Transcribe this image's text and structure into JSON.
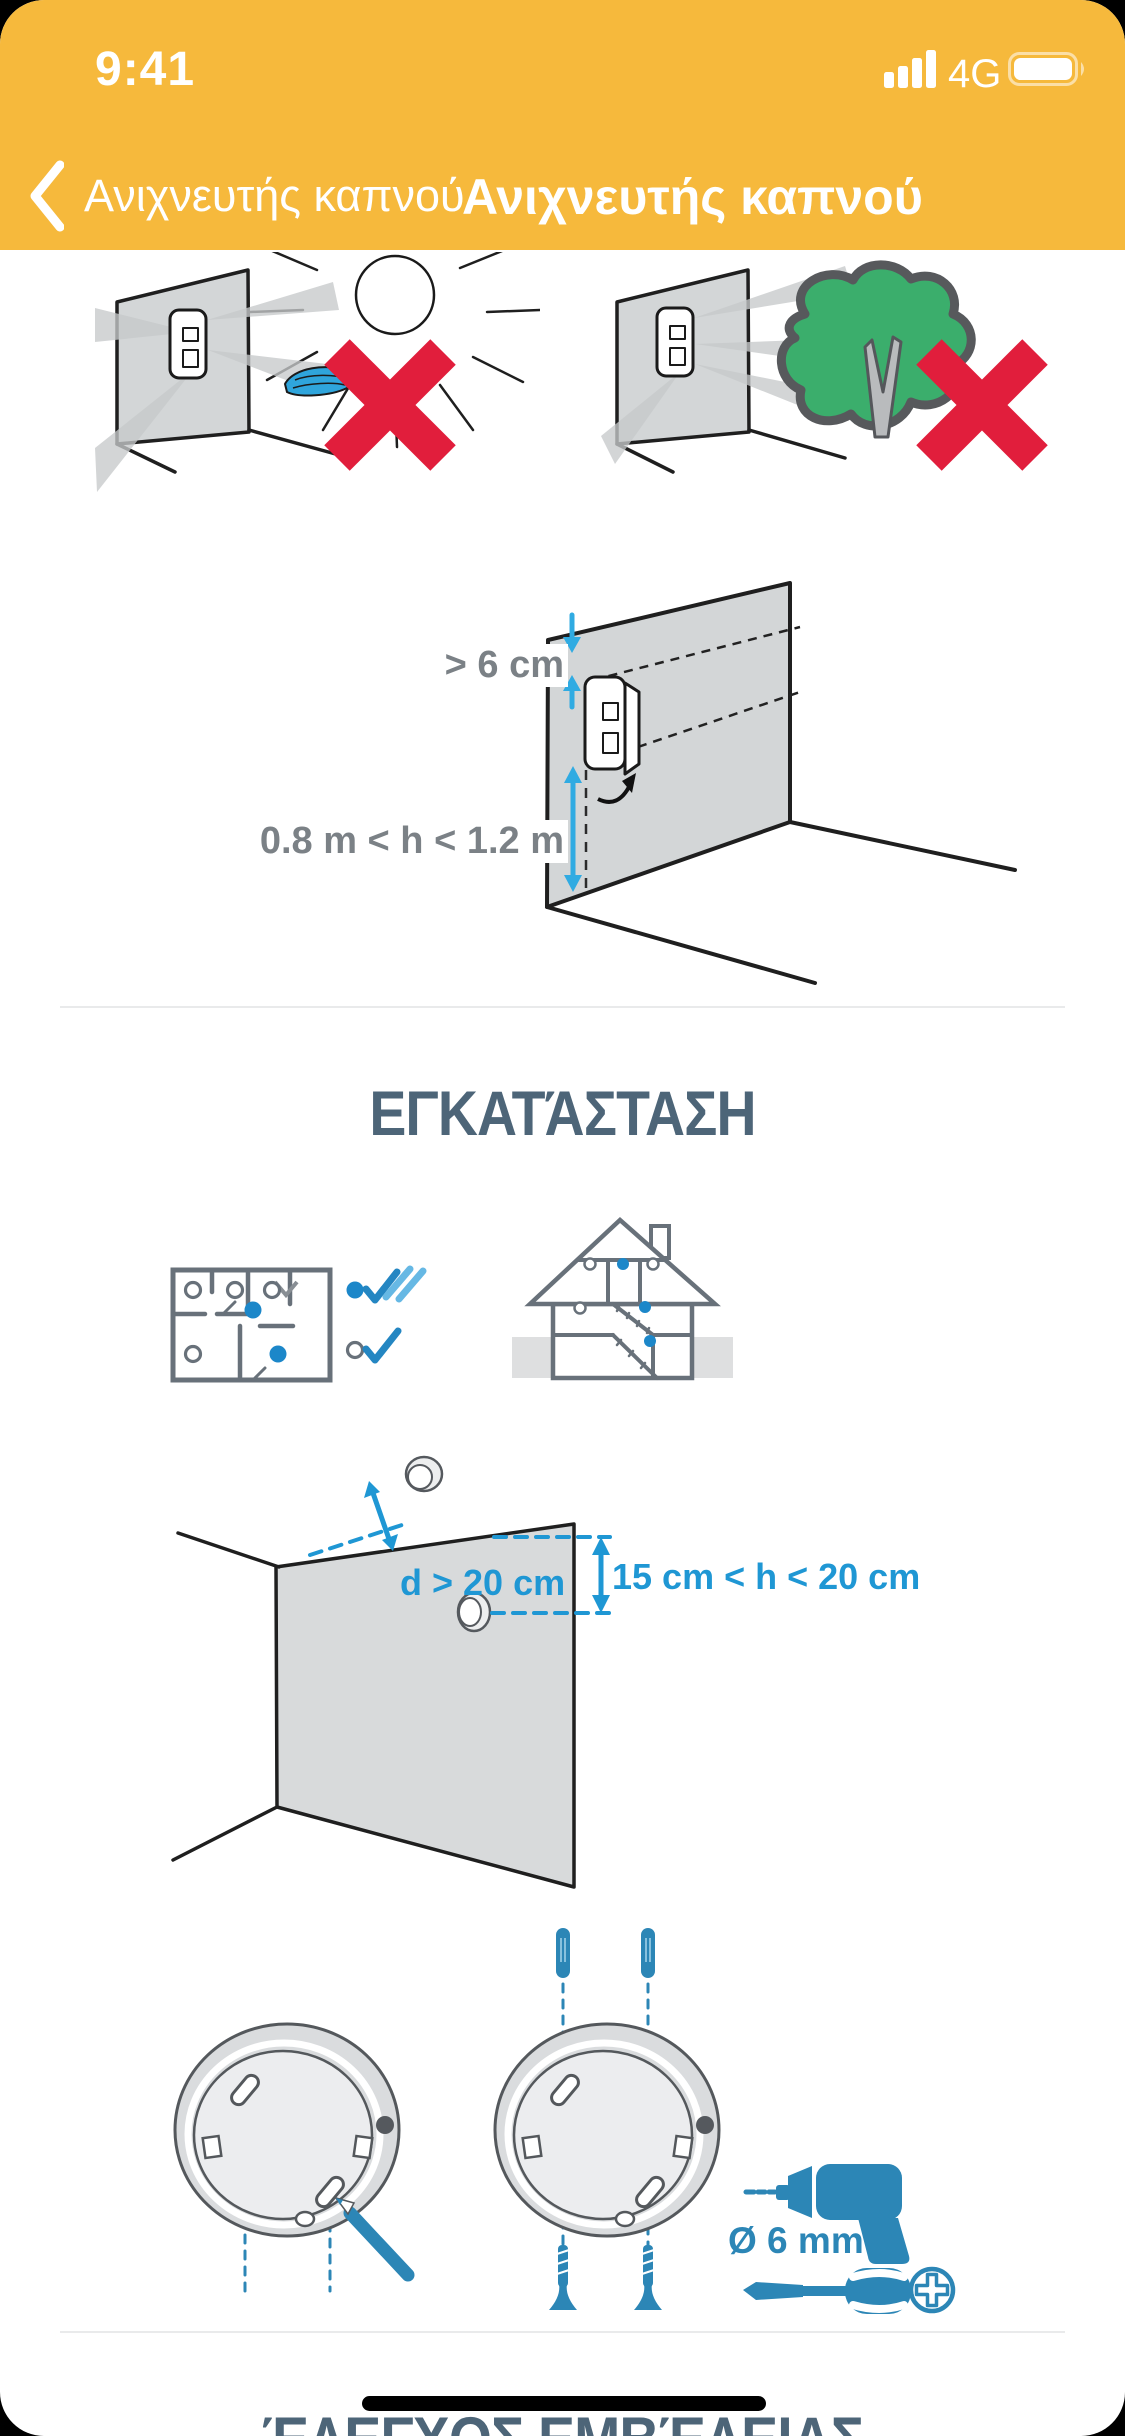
{
  "status_bar": {
    "time": "9:41",
    "network": "4G"
  },
  "nav": {
    "back_label": "Ανιχνευτής καπνού",
    "title": "Ανιχνευτής καπνού"
  },
  "headings": {
    "installation": "ΕΓΚΑΤΆΣΤΑΣΗ",
    "range_check": "ΈΛΕΓΧΟΣ ΕΜΒΈΛΕΙΑΣ"
  },
  "labels": {
    "top_clearance": "> 6 cm",
    "mounting_height": "0.8 m < h < 1.2 m",
    "corner_distance": "d > 20 cm",
    "ceiling_gap": "15 cm < h < 20 cm",
    "drill_diameter": "Ø 6 mm"
  },
  "icons": {
    "back": "chevron-left-icon",
    "signal": "signal-bars-icon",
    "battery": "battery-full-icon",
    "illustrations": [
      "no-sunlight-warning-illustration",
      "no-tree-warning-illustration",
      "wall-mount-height-illustration",
      "floorplan-placement-illustration",
      "house-section-placement-illustration",
      "corner-distance-illustration",
      "base-marking-pencil-illustration",
      "base-plugs-screws-illustration",
      "drill-icon",
      "screwdriver-icon",
      "phillips-head-icon"
    ]
  },
  "colors": {
    "header_yellow": "#F6B93C",
    "heading_slate": "#4D6578",
    "measure_gray": "#7B8186",
    "measure_blue": "#1F97D4",
    "arrow_cyan": "#30ABE2",
    "tool_blue": "#2C86B6",
    "warning_red": "#E11E3C",
    "tree_green": "#3BAE6C",
    "line_gray": "#68717A",
    "dot_blue": "#1C87C9"
  }
}
